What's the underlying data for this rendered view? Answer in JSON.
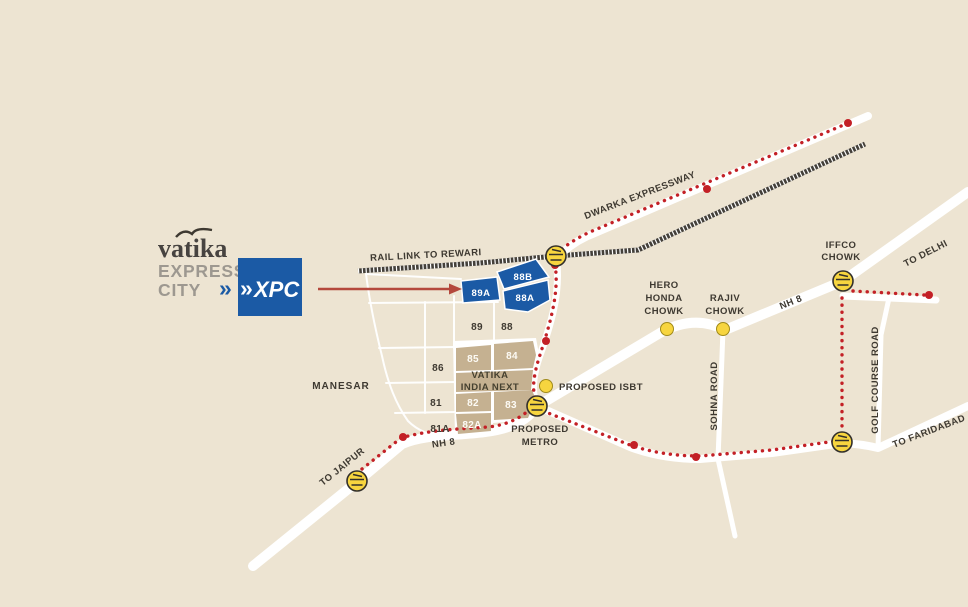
{
  "colors": {
    "background": "#EDE4D2",
    "road_white": "#FFFFFF",
    "sector_blue": "#1B5AA5",
    "sector_tan": "#C5B191",
    "route_red": "#C32026",
    "marker_yellow": "#F7D53F",
    "railway_dark": "#44403A",
    "text_dark": "#3E3931",
    "logo_gray": "#9D9890",
    "arrow_red": "#B4483C"
  },
  "logo": {
    "brand": "vatika",
    "sub1": "EXPRESS",
    "sub2": "CITY",
    "chevrons_outer": "»",
    "chevrons_inner": "»",
    "badge_text": "XPC"
  },
  "labels": {
    "rail_link": "RAIL LINK TO REWARI",
    "dwarka_expressway": "DWARKA EXPRESSWAY",
    "to_delhi": "TO DELHI",
    "to_jaipur": "TO JAIPUR",
    "to_faridabad": "TO FARIDABAD",
    "nh8_northeast": "NH 8",
    "nh8_southwest": "NH 8",
    "sohna_road": "SOHNA ROAD",
    "golf_course_road": "GOLF COURSE ROAD",
    "manesar": "MANESAR",
    "iffco_chowk_line1": "IFFCO",
    "iffco_chowk_line2": "CHOWK",
    "hero_honda_line1": "HERO",
    "hero_honda_line2": "HONDA",
    "hero_honda_line3": "CHOWK",
    "rajiv_chowk_line1": "RAJIV",
    "rajiv_chowk_line2": "CHOWK",
    "proposed_isbt": "PROPOSED ISBT",
    "proposed_metro_line1": "PROPOSED",
    "proposed_metro_line2": "METRO",
    "vatika_india_next_line1": "VATIKA",
    "vatika_india_next_line2": "INDIA NEXT"
  },
  "sectors": {
    "highlighted_blue": [
      "88B",
      "89A",
      "88A"
    ],
    "filled_tan": [
      "85",
      "84",
      "82",
      "83",
      "82A"
    ],
    "outlined": [
      "89",
      "88",
      "86",
      "81",
      "81A"
    ]
  }
}
